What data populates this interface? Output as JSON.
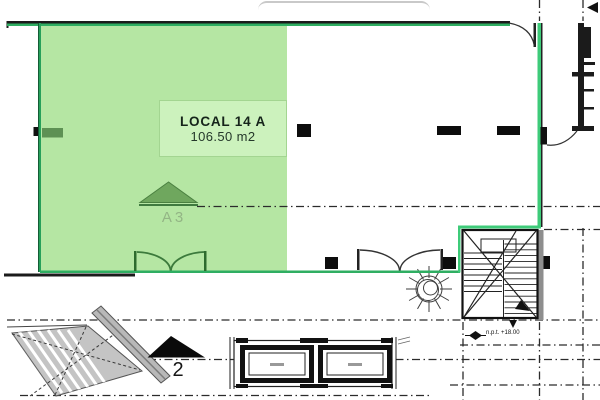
{
  "plan": {
    "highlighted_unit": {
      "name": "LOCAL 14 A",
      "area": "106.50 m2"
    },
    "markers": {
      "section_a3": "A3",
      "section_2": "2",
      "level_note": "n.p.t. +18.00"
    },
    "colors": {
      "highlight_fill": "#b5e6a3",
      "highlight_label_fill": "#ccf2bd",
      "boundary_green": "#2fae62",
      "boundary_bright_green": "#3ecb79",
      "triangle_green": "#6fa75e",
      "line_black": "#1b1b1b",
      "escalator_gray": "#c4c4c4"
    }
  }
}
